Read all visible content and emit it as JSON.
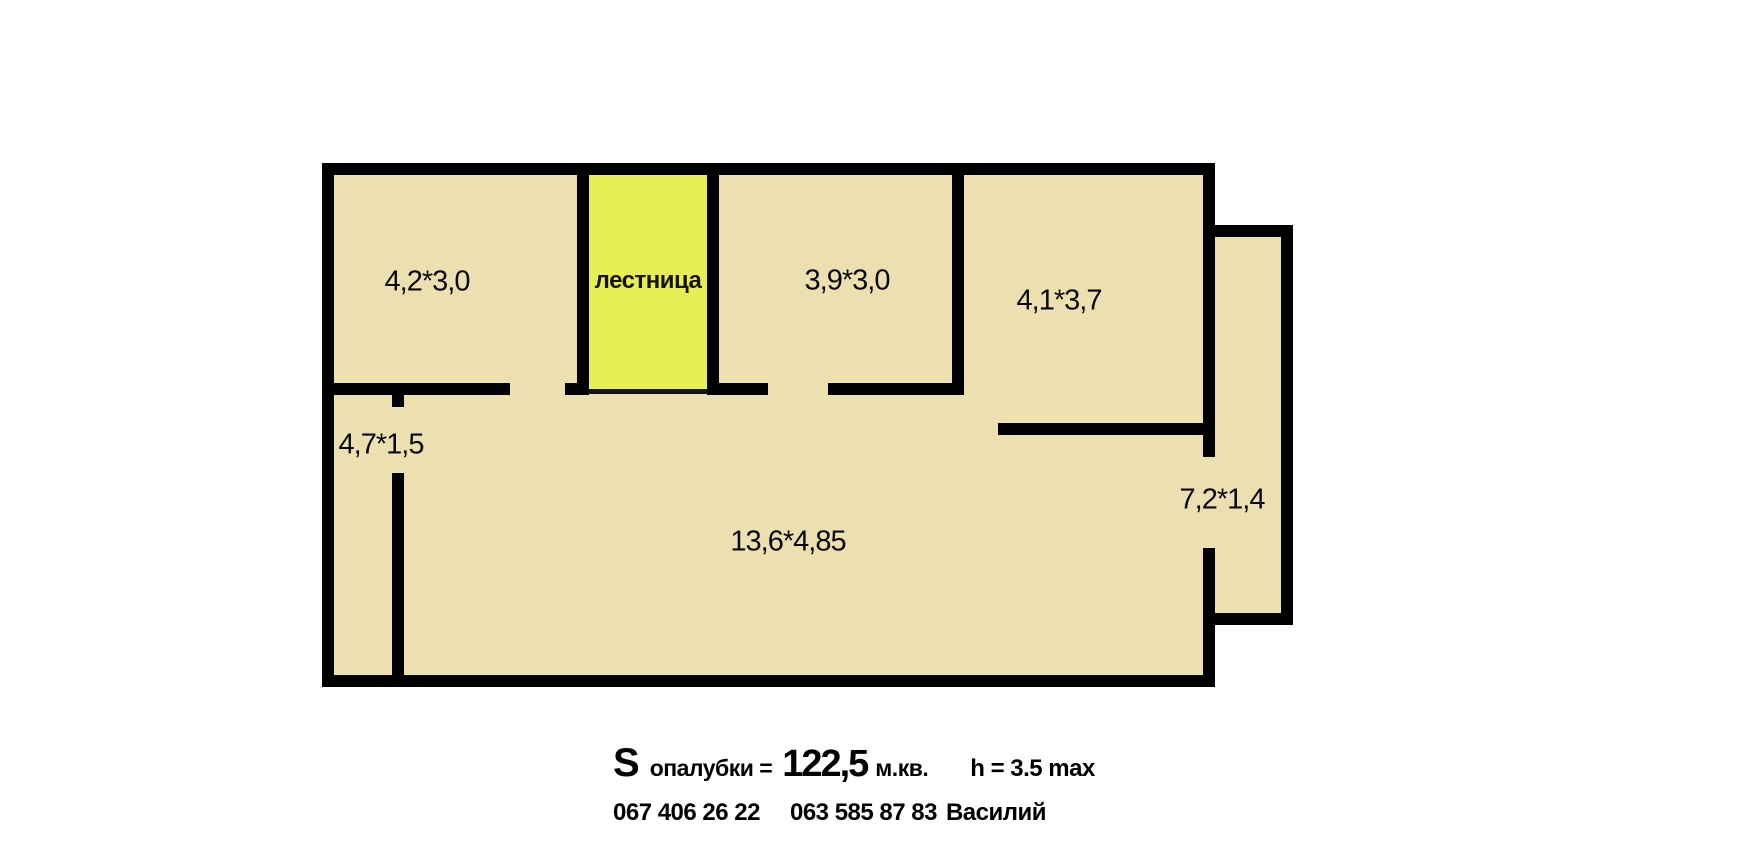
{
  "plan": {
    "rooms": [
      {
        "name": "room-top-left",
        "label": "4,2*3,0"
      },
      {
        "name": "staircase",
        "label": "лестница"
      },
      {
        "name": "room-top-middle",
        "label": "3,9*3,0"
      },
      {
        "name": "room-top-right",
        "label": "4,1*3,7"
      },
      {
        "name": "corridor-left",
        "label": "4,7*1,5"
      },
      {
        "name": "main-hall",
        "label": "13,6*4,85"
      },
      {
        "name": "annex-right",
        "label": "7,2*1,4"
      }
    ],
    "colors": {
      "floor": "#ece0b0",
      "staircase_fill": "#e8ee55",
      "wall": "#000000",
      "background": "#ffffff"
    }
  },
  "footer": {
    "area": {
      "prefix": "S",
      "label": "опалубки =",
      "value": "122,5",
      "unit": "м.кв."
    },
    "height_limit": "h = 3.5 max",
    "contacts": {
      "phone1": "067 406 26 22",
      "phone2": "063 585 87 83",
      "name": "Василий"
    }
  }
}
